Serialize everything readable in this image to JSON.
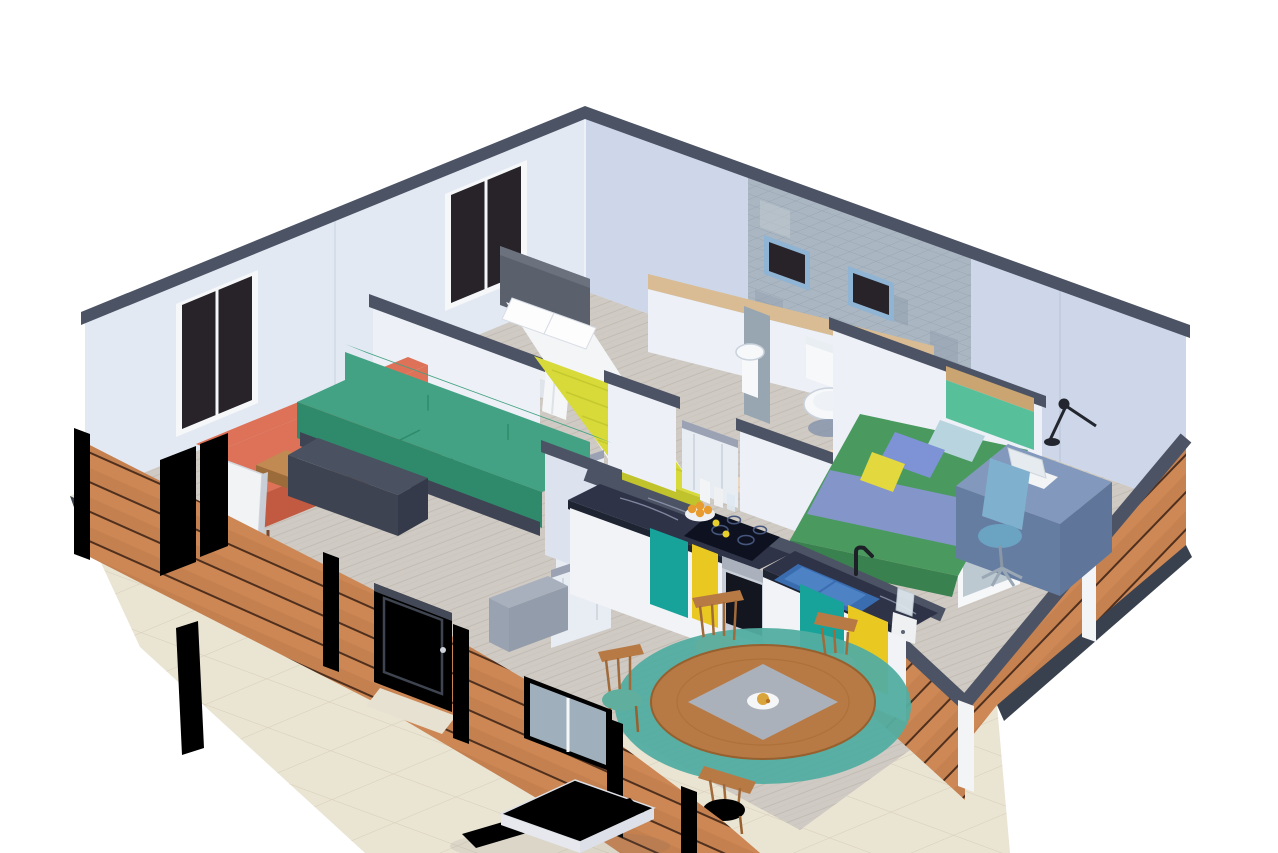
{
  "scene": {
    "type": "3d-isometric-floor-plan-render",
    "rooms": [
      {
        "name": "living-room",
        "objects": [
          "orange-sofa",
          "green-sofa",
          "coffee-table",
          "magazines",
          "tv-cabinet",
          "tv"
        ]
      },
      {
        "name": "master-bedroom",
        "objects": [
          "double-bed",
          "yellow-blanket",
          "pillows",
          "headboard",
          "vanity-shelf",
          "cosmetics",
          "teal-stool",
          "towel",
          "window"
        ]
      },
      {
        "name": "bathroom",
        "objects": [
          "toilet",
          "sink",
          "bidet",
          "mosaic-tile-wall",
          "two-small-windows"
        ]
      },
      {
        "name": "bedroom-2",
        "objects": [
          "single-bed",
          "green-blanket",
          "blue-pillow",
          "yellow-cushion",
          "desk",
          "laptop",
          "desk-lamp",
          "office-chair"
        ]
      },
      {
        "name": "kitchen",
        "objects": [
          "teal-cabinet",
          "yellow-cabinet",
          "marble-counter",
          "induction-cooktop",
          "oven",
          "double-sink-blue",
          "faucet",
          "blender",
          "fruit-bowl",
          "bottles"
        ]
      },
      {
        "name": "dining-area",
        "objects": [
          "round-wood-table",
          "gray-runner",
          "plate",
          "four-wood-chairs",
          "teal-rug"
        ]
      },
      {
        "name": "patio",
        "objects": [
          "white-square-table",
          "blue-spindle-chair",
          "red-spindle-chair",
          "stone-tiles",
          "fence-posts",
          "glass-fence-panels",
          "entrance-door"
        ]
      }
    ]
  },
  "palette": {
    "bg": "#ffffff",
    "wall_left": "#e3e9f3",
    "wall_right": "#cdd7e9",
    "wall_cap": "#4c5364",
    "wall_inner": "#edf0f6",
    "wall_inner_shade": "#dde3ee",
    "tile_base": "#aab6c1",
    "tile_dark": "#98a6b2",
    "wood_plank": "#c5804f",
    "post_white": "#f3f4f6",
    "floor_wood": "#cfcac3",
    "floor_birch": "#ecd7be",
    "stone": "#eae4d3",
    "edge_navy": "#39414f",
    "glass_dark": "#272329",
    "frame_white": "#f6f7f9",
    "fence_glass": "#b9c6cf",
    "window_blue": "#8fb4d4",
    "bath_floor": "#e9e7e0",
    "sofa_orange": "#de7258",
    "sofa_orange_dark": "#c25a41",
    "sofa_green": "#42a283",
    "sofa_green_dark": "#2e8a6a",
    "table_wood": "#c08a52",
    "table_wood_dark": "#9c6b3a",
    "tv_dark": "#3d4351",
    "tv_white": "#f2f3f5",
    "bed_headboard": "#5a606c",
    "bed_sheet": "#f4f5f7",
    "bed_yellow": "#d7da39",
    "bed_yellow_dark": "#c0c32b",
    "vanity_white": "#eef0f4",
    "stool_teal": "#6fc0b1",
    "toilet_white": "#f7f8fa",
    "toilet_shade": "#c9d2dd",
    "door_white": "#e8ecf3",
    "counter_marble": "#2e3347",
    "cab_teal": "#17a29a",
    "cab_yellow": "#eac822",
    "cab_white": "#f2f3f6",
    "oven_steel": "#aab1bc",
    "oven_black": "#14161f",
    "stove_black": "#0e1220",
    "sink_blue": "#4d82c4",
    "sink_blue_dark": "#3a6cb0",
    "faucet_black": "#1d2026",
    "blender_white": "#eef0f2",
    "fruit_orange": "#e89b2e",
    "fruit_yellow": "#e8d02c",
    "dining_wood": "#b87a45",
    "dining_wood_dark": "#96602f",
    "seat_teal": "#5fae9e",
    "rug_teal": "#52ada1",
    "runner_gray": "#abb1ba",
    "plate_white": "#f5f6f7",
    "bed2_green": "#4a9a5f",
    "bed2_green_dark": "#3a8150",
    "pillow_blue": "#7e93d6",
    "pillow_light": "#b8d4de",
    "cushion_yellow": "#e3d83e",
    "headboard2_teal": "#58bf9b",
    "headboard2_wood": "#caa471",
    "desk_blue": "#8298bc",
    "desk_blue_dark": "#667da2",
    "chair_blue": "#7fb0cd",
    "lamp_black": "#23262e",
    "laptop_white": "#f2f4f6",
    "entry_door": "#5b616c",
    "patio_table": "#f4f5f7",
    "patio_chair_blue": "#2a49b6",
    "patio_chair_red": "#c92f22",
    "shoe_cabinet": "#a8b0bd"
  }
}
